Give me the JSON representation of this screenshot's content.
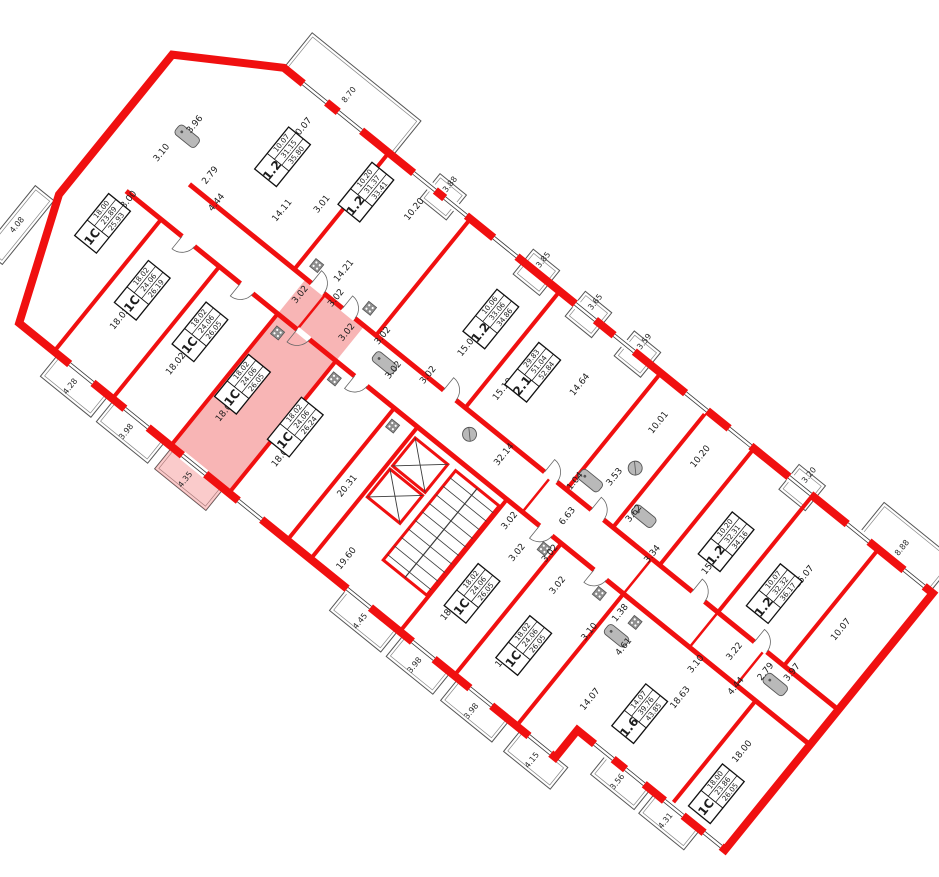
{
  "plan": {
    "title": "floor-plan",
    "wall_color": "#f01010",
    "thin_line_color": "#3a3a3a",
    "fixture_color": "#b9b9b9",
    "highlight_color": "#f26b6b",
    "core": {
      "elevators": 2,
      "stairs": true
    },
    "apartments": [
      {
        "type": "1.2",
        "values": [
          "10.07",
          "31.15",
          "35.80"
        ],
        "highlighted": false
      },
      {
        "type": "1.2",
        "values": [
          "10.20",
          "31.37",
          "33.41"
        ],
        "highlighted": false
      },
      {
        "type": "1.2",
        "values": [
          "10.06",
          "33.06",
          "34.86"
        ],
        "highlighted": false
      },
      {
        "type": "2.1",
        "values": [
          "29.83",
          "51.04",
          "52.84"
        ],
        "highlighted": false
      },
      {
        "type": "1.2",
        "values": [
          "10.20",
          "32.31",
          "34.16"
        ],
        "highlighted": false
      },
      {
        "type": "1.2",
        "values": [
          "10.07",
          "32.32",
          "36.17"
        ],
        "highlighted": false
      },
      {
        "type": "1.6",
        "values": [
          "14.07",
          "39.76",
          "43.85"
        ],
        "highlighted": false
      },
      {
        "type": "1C",
        "values": [
          "18.00",
          "23.86",
          "26.05"
        ],
        "highlighted": false
      },
      {
        "type": "1C",
        "values": [
          "18.00",
          "23.89",
          "25.93"
        ],
        "highlighted": false
      },
      {
        "type": "1C",
        "values": [
          "18.02",
          "24.06",
          "26.19"
        ],
        "highlighted": false
      },
      {
        "type": "1C",
        "values": [
          "18.02",
          "24.06",
          "26.05"
        ],
        "highlighted": false
      },
      {
        "type": "1C",
        "values": [
          "18.02",
          "24.06",
          "26.05"
        ],
        "highlighted": true
      },
      {
        "type": "1C",
        "values": [
          "18.02",
          "24.06",
          "26.24"
        ],
        "highlighted": false
      },
      {
        "type": "1C",
        "values": [
          "18.02",
          "24.06",
          "26.05"
        ],
        "highlighted": false
      },
      {
        "type": "1C",
        "values": [
          "18.02",
          "24.06",
          "26.05"
        ],
        "highlighted": false
      }
    ],
    "room_labels": [
      {
        "t": "10.07",
        "x": 150,
        "y": 36
      },
      {
        "t": "14.11",
        "x": 186,
        "y": 112
      },
      {
        "t": "3.01",
        "x": 213,
        "y": 82
      },
      {
        "t": "2.79",
        "x": 108,
        "y": 130
      },
      {
        "t": "3.10",
        "x": 56,
        "y": 143
      },
      {
        "t": "3.96",
        "x": 64,
        "y": 100
      },
      {
        "t": "4.44",
        "x": 130,
        "y": 147
      },
      {
        "t": "10.20",
        "x": 288,
        "y": 28
      },
      {
        "t": "14.21",
        "x": 272,
        "y": 120
      },
      {
        "t": "15.08",
        "x": 415,
        "y": 100
      },
      {
        "t": "3.02",
        "x": 253,
        "y": 166
      },
      {
        "t": "3.02",
        "x": 283,
        "y": 146
      },
      {
        "t": "3.02",
        "x": 313,
        "y": 166
      },
      {
        "t": "3.02",
        "x": 343,
        "y": 146
      },
      {
        "t": "3.02",
        "x": 373,
        "y": 166
      },
      {
        "t": "3.02",
        "x": 403,
        "y": 148
      },
      {
        "t": "14.64",
        "x": 527,
        "y": 60
      },
      {
        "t": "15.19",
        "x": 470,
        "y": 112
      },
      {
        "t": "10.01",
        "x": 612,
        "y": 40
      },
      {
        "t": "10.20",
        "x": 666,
        "y": 40
      },
      {
        "t": "3.53",
        "x": 612,
        "y": 110
      },
      {
        "t": "1.04",
        "x": 584,
        "y": 138
      },
      {
        "t": "3.62",
        "x": 650,
        "y": 126
      },
      {
        "t": "3.34",
        "x": 690,
        "y": 146
      },
      {
        "t": "15.15",
        "x": 742,
        "y": 116
      },
      {
        "t": "15.07",
        "x": 822,
        "y": 68
      },
      {
        "t": "10.07",
        "x": 884,
        "y": 86
      },
      {
        "t": "3.97",
        "x": 873,
        "y": 150
      },
      {
        "t": "2.79",
        "x": 852,
        "y": 166
      },
      {
        "t": "3.22",
        "x": 815,
        "y": 170
      },
      {
        "t": "4.44",
        "x": 838,
        "y": 196
      },
      {
        "t": "3.10",
        "x": 793,
        "y": 204
      },
      {
        "t": "1.38",
        "x": 702,
        "y": 212
      },
      {
        "t": "4.61",
        "x": 726,
        "y": 236
      },
      {
        "t": "3.10",
        "x": 690,
        "y": 246
      },
      {
        "t": "18.00",
        "x": 60,
        "y": 203
      },
      {
        "t": "18.02",
        "x": 128,
        "y": 298
      },
      {
        "t": "18.02",
        "x": 200,
        "y": 298
      },
      {
        "t": "18.02",
        "x": 268,
        "y": 303
      },
      {
        "t": "18.02",
        "x": 340,
        "y": 303
      },
      {
        "t": "18.02",
        "x": 568,
        "y": 316
      },
      {
        "t": "18.02",
        "x": 640,
        "y": 318
      },
      {
        "t": "18.63",
        "x": 802,
        "y": 240
      },
      {
        "t": "14.07",
        "x": 733,
        "y": 298
      },
      {
        "t": "18.00",
        "x": 884,
        "y": 243
      },
      {
        "t": "3.02",
        "x": 558,
        "y": 210
      },
      {
        "t": "3.02",
        "x": 584,
        "y": 230
      },
      {
        "t": "3.02",
        "x": 610,
        "y": 210
      },
      {
        "t": "3.02",
        "x": 636,
        "y": 230
      }
    ],
    "corridor_labels": [
      {
        "t": "32.14",
        "x": 512,
        "y": 162
      },
      {
        "t": "6.63",
        "x": 600,
        "y": 170
      },
      {
        "t": "20.31",
        "x": 410,
        "y": 285
      },
      {
        "t": "19.60",
        "x": 455,
        "y": 342
      }
    ],
    "balcony_labels": [
      {
        "t": "8.70",
        "x": 165,
        "y": -20
      },
      {
        "t": "3.88",
        "x": 300,
        "y": -14
      },
      {
        "t": "3.85",
        "x": 420,
        "y": -14
      },
      {
        "t": "3.65",
        "x": 487,
        "y": -14
      },
      {
        "t": "3.59",
        "x": 550,
        "y": -14
      },
      {
        "t": "3.20",
        "x": 762,
        "y": -14
      },
      {
        "t": "8.88",
        "x": 880,
        "y": -16
      },
      {
        "t": "4.08",
        "x": -11,
        "y": 290
      },
      {
        "t": "4.28",
        "x": 132,
        "y": 382
      },
      {
        "t": "3.98",
        "x": 204,
        "y": 382
      },
      {
        "t": "4.35",
        "x": 280,
        "y": 382
      },
      {
        "t": "4.45",
        "x": 505,
        "y": 382
      },
      {
        "t": "3.98",
        "x": 575,
        "y": 382
      },
      {
        "t": "3.98",
        "x": 648,
        "y": 382
      },
      {
        "t": "4.15",
        "x": 726,
        "y": 382
      },
      {
        "t": "3.56",
        "x": 806,
        "y": 345
      },
      {
        "t": "4.31",
        "x": 868,
        "y": 345
      }
    ]
  }
}
